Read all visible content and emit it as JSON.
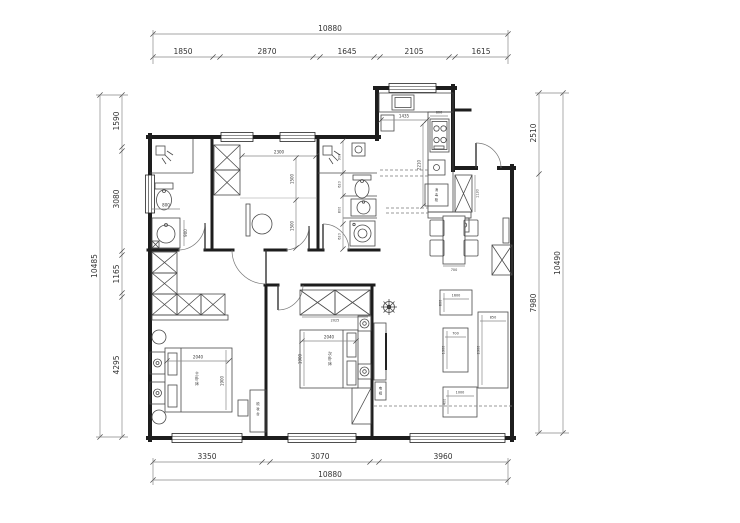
{
  "dims": {
    "top": {
      "overall": "10880",
      "s1": "1850",
      "s2": "2870",
      "s3": "1645",
      "s4": "2105",
      "s5": "1615"
    },
    "bottom": {
      "overall": "10880",
      "s1": "3350",
      "s2": "3070",
      "s3": "3960"
    },
    "left": {
      "overall": "10485",
      "s1": "1590",
      "s2": "3080",
      "s3": "1165",
      "s4": "4295"
    },
    "right": {
      "overall": "10490",
      "s1": "2510",
      "s2": "7980"
    }
  },
  "kitchen": {
    "counter_w": "1435",
    "stove_w": "600",
    "depth": "2210",
    "appliance": [
      "消",
      "毒",
      "柜"
    ]
  },
  "study": {
    "width": "2300",
    "h1": "1500",
    "h2": "1500"
  },
  "bath1": {
    "toilet_w": "800",
    "vanity_h": "900"
  },
  "bath2": {
    "s1": "900",
    "s2": "620",
    "s3": "800",
    "s4": "620"
  },
  "dining": {
    "cabinet_h": "1130",
    "table_w": "700"
  },
  "living": {
    "bench_w": "1600",
    "bench_h": "800",
    "table_w": "700",
    "table_h": "1300",
    "sofa_d": "850",
    "sofa_w": "2300",
    "stand_w": "1000",
    "stand_h": "400",
    "tv": [
      "电",
      "视"
    ]
  },
  "bedroom1": {
    "bed_w": "2040",
    "bed_l": "1900",
    "bed_label": [
      "主",
      "卧",
      "床"
    ],
    "dresser_label": [
      "梳",
      "妆",
      "台"
    ]
  },
  "bedroom2": {
    "wardrobe_w": "2025",
    "bed_w": "2040",
    "bed_l": "1900",
    "bed_label": [
      "次",
      "卧",
      "床"
    ]
  }
}
